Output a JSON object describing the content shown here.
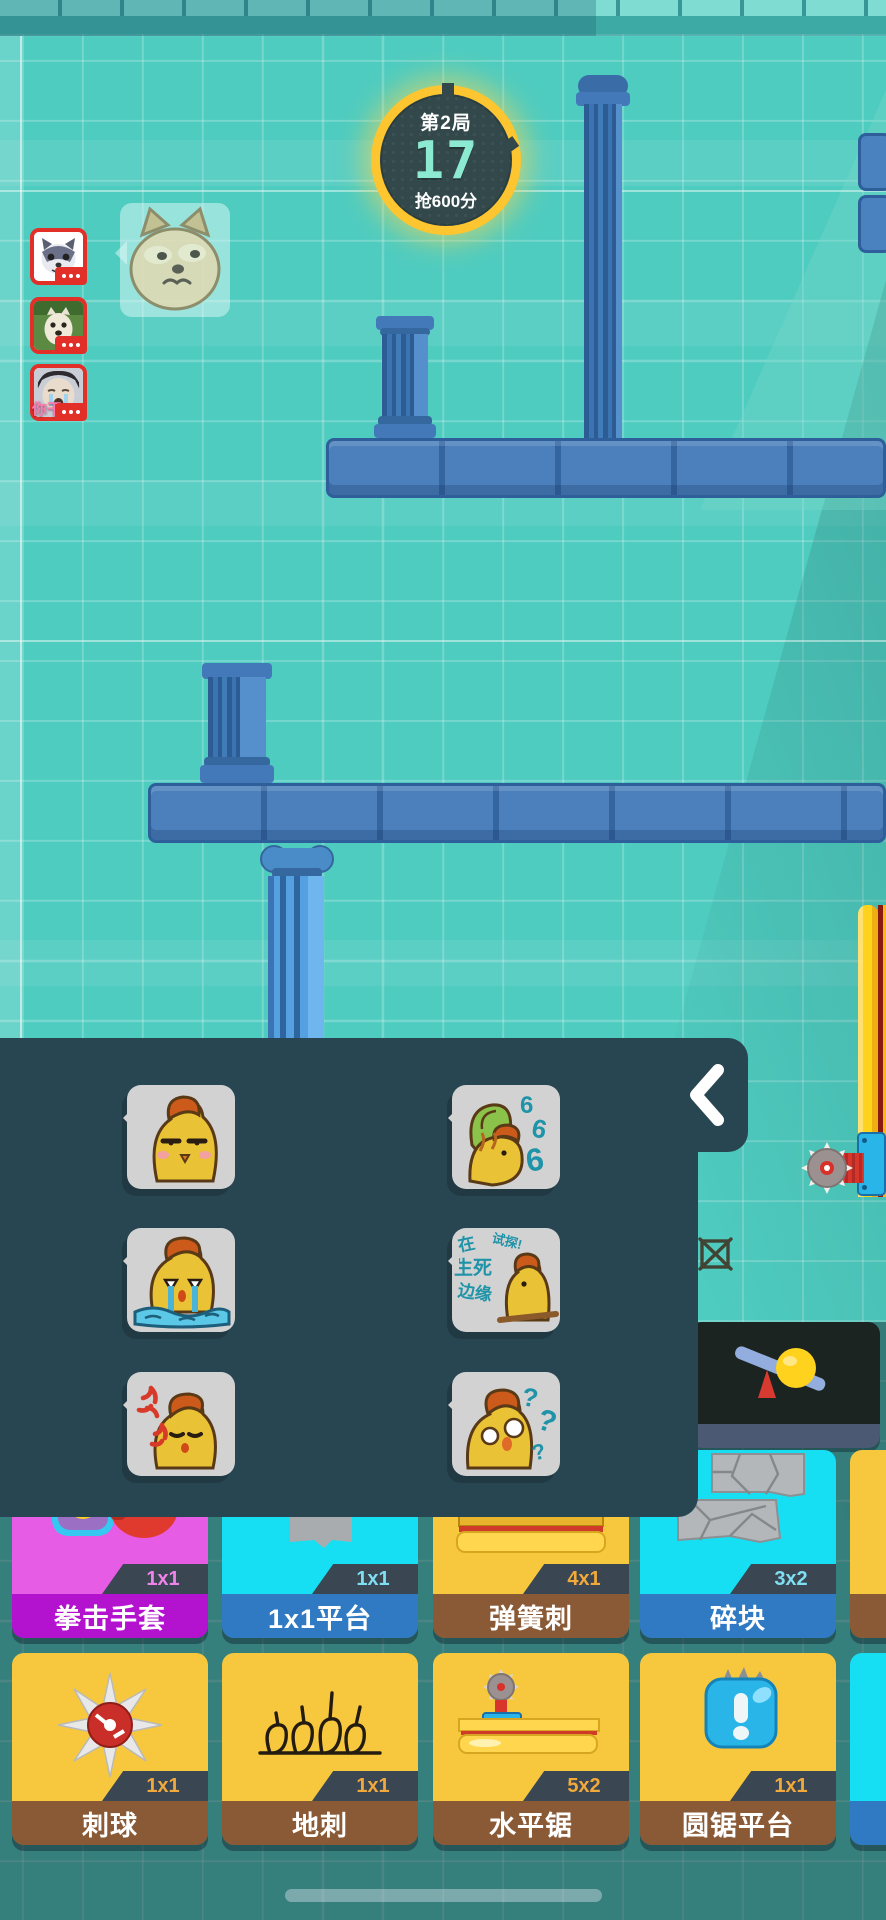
{
  "hud": {
    "round_badge": {
      "round": "第2局",
      "countdown": "17",
      "objective": "抢600分"
    },
    "players": [
      {
        "avatar": "husky-cartoon-avatar"
      },
      {
        "avatar": "puppy-photo-avatar"
      },
      {
        "avatar": "crying-meme-avatar",
        "overlay_text": "你干"
      }
    ]
  },
  "emote_panel": {
    "collapse_icon": "chevron-left",
    "emotes": [
      {
        "name": "smug-chicken"
      },
      {
        "name": "666-chicken",
        "digits": [
          "6",
          "6",
          "6"
        ]
      },
      {
        "name": "crying-chicken"
      },
      {
        "name": "life-death-chicken",
        "text_lines": [
          "在",
          "生死",
          "边缘",
          "试探!"
        ]
      },
      {
        "name": "angry-chicken"
      },
      {
        "name": "confused-chicken",
        "marks": [
          "?",
          "?",
          "?"
        ]
      }
    ]
  },
  "toolbar": {
    "rows": [
      {
        "cards": [
          {
            "label": "",
            "icon": "seesaw"
          }
        ]
      },
      {
        "cards": [
          {
            "label": "拳击手套",
            "size": "1x1",
            "body_color": "#e75ce4",
            "bar_color": "#b312cf",
            "size_color": "#ef83ea"
          },
          {
            "label": "1x1平台",
            "size": "1x1",
            "body_color": "#16dff4",
            "bar_color": "#2f7ac2",
            "size_color": "#7fdff2"
          },
          {
            "label": "弹簧刺",
            "size": "4x1",
            "body_color": "#f7c83d",
            "bar_color": "#8a5a36",
            "size_color": "#f2a93c"
          },
          {
            "label": "碎块",
            "size": "3x2",
            "body_color": "#16dff4",
            "bar_color": "#2f7ac2",
            "size_color": "#7fdff2"
          },
          {
            "label": "",
            "size": "",
            "partial": true,
            "body_color": "#f7c83d",
            "bar_color": "#8a5a36"
          }
        ]
      },
      {
        "cards": [
          {
            "label": "刺球",
            "size": "1x1",
            "body_color": "#f7c83d",
            "bar_color": "#8a5a36",
            "size_color": "#f2a93c"
          },
          {
            "label": "地刺",
            "size": "1x1",
            "body_color": "#f7c83d",
            "bar_color": "#8a5a36",
            "size_color": "#f2a93c"
          },
          {
            "label": "水平锯",
            "size": "5x2",
            "body_color": "#f7c83d",
            "bar_color": "#8a5a36",
            "size_color": "#f2a93c"
          },
          {
            "label": "圆锯平台",
            "size": "1x1",
            "body_color": "#f7c83d",
            "bar_color": "#8a5a36",
            "size_color": "#f2a93c"
          },
          {
            "label": "",
            "size": "",
            "partial": true,
            "body_color": "#16dff4",
            "bar_color": "#2f7ac2"
          }
        ]
      }
    ]
  },
  "colors": {
    "background_teal": "#4fccc0",
    "platform_blue": "#4b80bc",
    "panel_dark": "#284652",
    "timer_ring": "#fdc52f",
    "timer_count": "#8cead2",
    "avatar_border": "#e23028"
  }
}
